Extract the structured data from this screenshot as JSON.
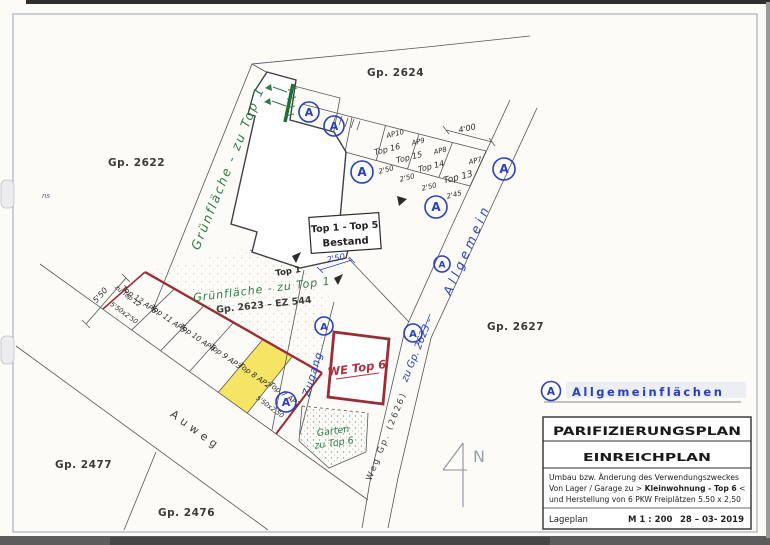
{
  "sheet": {
    "margin_mark": "ns"
  },
  "parcels": {
    "gp2624": "Gp.  2624",
    "gp2622": "Gp.  2622",
    "gp2627": "Gp.  2627",
    "gp2477": "Gp.  2477",
    "gp2476": "Gp.  2476",
    "gp2623_ez": "Gp.  2623 – EZ 544"
  },
  "roads": {
    "auweg": "Auweg",
    "weg": "Weg Gp. (2626)",
    "note_zu": "zu Gp. 2623 -",
    "note_allgemein": "Allgemein"
  },
  "greenspace": {
    "strip_label": "Grünfläche - zu Top 1",
    "parcel_label": "Grünfläche - zu Top 1",
    "garden_line1": "Garten",
    "garden_line2": "zu Top 6"
  },
  "building": {
    "box_line1": "Top 1 - Top 5",
    "box_line2": "Bestand",
    "entrance_label": "Top 1",
    "dim_entrance": "2'50"
  },
  "unit6": {
    "label": "WE Top 6"
  },
  "access": {
    "zugang": "Zugang"
  },
  "parking_upper": {
    "ap": [
      "AP10",
      "AP9",
      "AP8",
      "AP7"
    ],
    "top": [
      "Top 16",
      "Top 15",
      "Top 14",
      "Top 13"
    ],
    "dims": [
      "2'50",
      "2'50",
      "2'50",
      "2'45"
    ],
    "dim_400": "4'00"
  },
  "parking_left": {
    "triangle_label": "zu Top 12",
    "stalls": [
      "Top 12 AP6",
      "Top 11 AP5",
      "Top 10 AP4",
      "Top 9 AP3",
      "Top 8 AP2",
      "Top 7 AP1"
    ],
    "dim_first": "5'50x2'50",
    "dim_last": "5'50x2,50",
    "dim_depth": "5'50"
  },
  "symbols": {
    "allgemein": "A"
  },
  "north": {
    "label": "N"
  },
  "legend": {
    "label": "Allgemeinflächen"
  },
  "title_block": {
    "title": "PARIFIZIERUNGSPLAN",
    "subtitle": "EINREICHPLAN",
    "desc1": "Umbau bzw. Änderung des Verwendungszweckes",
    "desc2_pre": "Von Lager / Garage zu > ",
    "desc2_bold": "Kleinwohnung - Top 6",
    "desc2_post": " <",
    "desc3": "und Herstellung von 6 PKW Freiplätzen 5.50 x 2,50",
    "doc_type": "Lageplan",
    "scale": "M  1 : 200",
    "date": "28 – 03- 2019"
  },
  "colors": {
    "blue": "#2540c0",
    "green": "#2e7d46",
    "red": "#9b2c33",
    "yellow": "#f4e04a"
  }
}
